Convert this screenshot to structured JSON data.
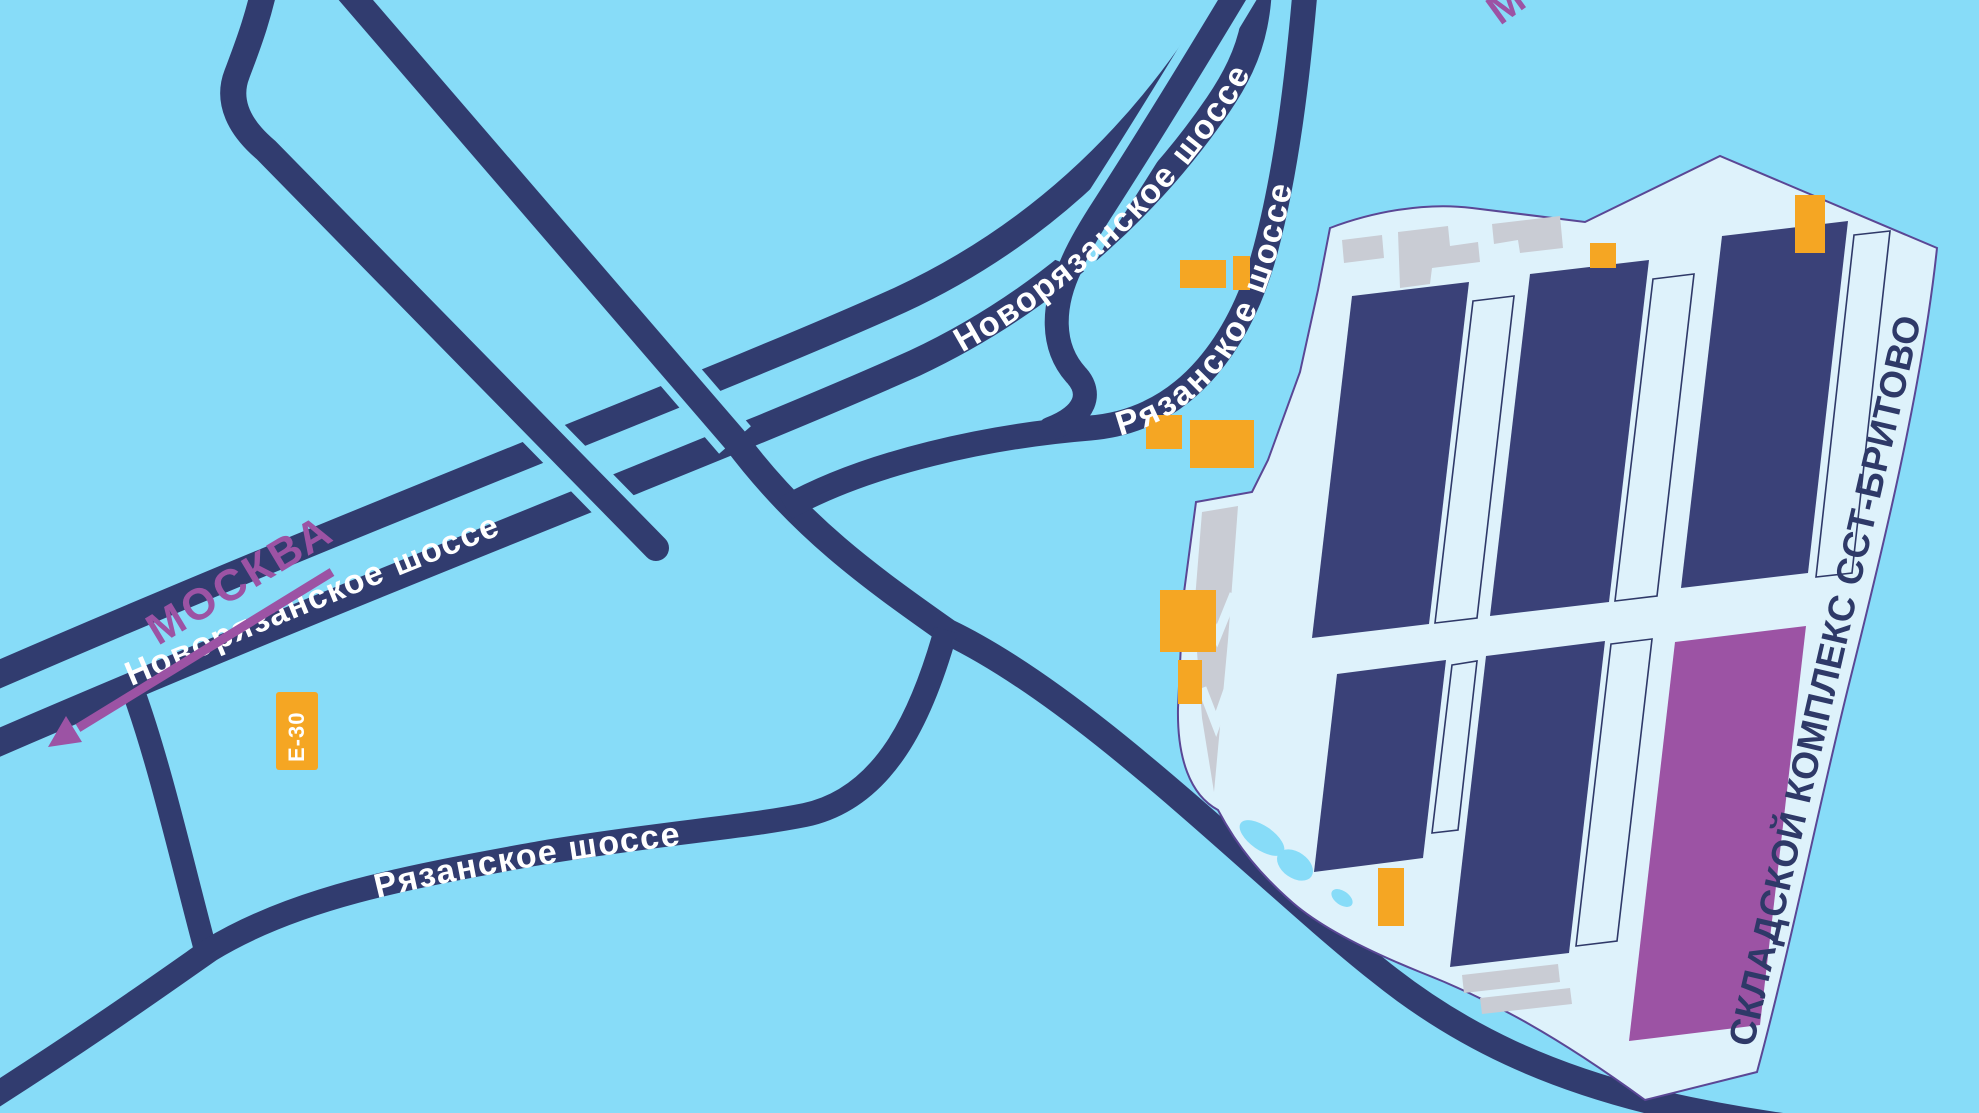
{
  "map": {
    "type": "schematic-route-map",
    "road_labels": {
      "novoryazanskoe_lower": "Новорязанское шоссе",
      "novoryazanskoe_upper": "Новорязанское шоссе",
      "ryazanskoe_north": "Рязанское шоссе",
      "ryazanskoe_south": "Рязанское шоссе"
    },
    "directions": {
      "moscow_arrow_label": "МОСКВА",
      "moscow_top_partial": "М"
    },
    "route_badge": {
      "label": "Е-30"
    },
    "complex": {
      "name": "СКЛАДСКОЙ КОМПЛЕКС ССТ-БРИТОВО"
    },
    "colors": {
      "background": "#87DCF8",
      "road": "#313C6F",
      "road_label": "#FFFFFF",
      "accent_purple": "#9C53A4",
      "orange": "#F5A623",
      "complex_fill": "#DEF2FB",
      "complex_outline": "#5A4795",
      "building_navy": "#3A4178",
      "building_purple": "#9C53A4",
      "gray": "#C9CCD4"
    }
  }
}
